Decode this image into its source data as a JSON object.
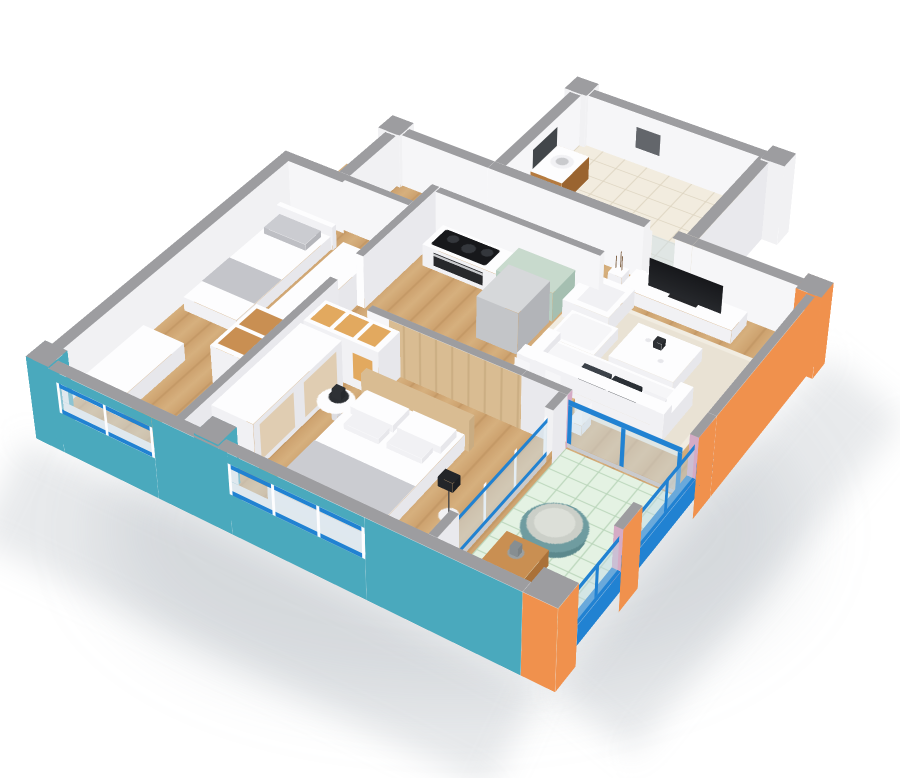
{
  "scene": {
    "title": "Two-bedroom apartment - 3D cutaway isometric floor plan",
    "view": "bird's-eye isometric render",
    "background": "#ffffff",
    "wall_tops": "gray",
    "exterior_walls": {
      "south": "teal",
      "east": "orange",
      "north": "white",
      "west": "white"
    },
    "window_style": "blue rails with white mullions and glass",
    "wall_cut_ends": "pink",
    "balcony_railing": "blue frame with glass panels"
  },
  "rooms": [
    {
      "id": "bathroom",
      "name": "Bathroom",
      "floor": "cream tile",
      "items": [
        "wood vanity with sink",
        "wall mirror",
        "toilet",
        "dark towel",
        "marble feature wall"
      ]
    },
    {
      "id": "hallway",
      "name": "Entrance Hall",
      "floor": "wood",
      "items": []
    },
    {
      "id": "kitchen",
      "name": "Kitchen",
      "floor": "wood",
      "items": [
        "counter with black cooktop",
        "built-in oven",
        "sage green cabinet",
        "gray refrigerator column"
      ]
    },
    {
      "id": "living",
      "name": "Living Room",
      "floor": "wood",
      "items": [
        "flat-screen TV",
        "white media stand",
        "vase with dry branches",
        "white sofa with chaise",
        "dark accent pillows",
        "white cube armchair",
        "white coffee table with cups",
        "beige rug"
      ]
    },
    {
      "id": "dining",
      "name": "Dining Area",
      "floor": "wood",
      "items": [
        "wooden dining table",
        "white chairs",
        "green potted plant"
      ]
    },
    {
      "id": "kids-bedroom",
      "name": "Kids Bedroom",
      "floor": "wood",
      "items": [
        "single bed with gray pillow",
        "open shelving with wood cubbies",
        "white desk"
      ]
    },
    {
      "id": "master-bedroom",
      "name": "Master Bedroom",
      "floor": "wood",
      "items": [
        "double bed with white pillows",
        "gray bed runner",
        "wood headboard wall panel",
        "white wardrobe",
        "cubby shelf",
        "round nightstand with fan",
        "floor lamp"
      ]
    },
    {
      "id": "balcony",
      "name": "Balcony",
      "floor": "mint tile",
      "items": [
        "teal papasan chair",
        "wooden side table with vase",
        "white pouf"
      ]
    }
  ],
  "palette": {
    "background": "#ffffff",
    "wall_cap": "#9d9da0",
    "wall_white": "#f6f6f8",
    "wall_white_bright": "#fbfbfc",
    "wall_white_soft": "#f1f1f3",
    "wall_white_shade": "#e9e9ed",
    "teal": "#4aa9bd",
    "orange": "#f0914d",
    "blue": "#2182d2",
    "blue_deep": "#1a6cb4",
    "pink": "#d5abc5",
    "glass": "rgba(206,224,234,0.5)",
    "glass_balcony": "rgba(190,215,230,0.45)",
    "wood_floor": "#cda26f",
    "wood_floor_light": "#d6b07e",
    "wood_floor_dark": "#bb905e",
    "wood_shelf": "#e2a95f",
    "wood_shelf_deep": "#c98f52",
    "headboard_wood": "#d9bc92",
    "sage": "#b7cec2",
    "sage_light": "#c8dacd",
    "sage_dark": "#a5bfb1",
    "mint": "#e4f2e3",
    "mint_line": "#b8d4b8",
    "cream": "#f2ecdf",
    "cream_line": "#ddd4c0",
    "marble_a": "#efe9dc",
    "marble_b": "#dcd4c2",
    "white": "#fdfdfe",
    "white_soft": "#f1f1f4",
    "white_shade": "#e7e7eb",
    "gray_pillow": "#cbccd1",
    "gray_runner": "#c4c5ca",
    "dark": "#2e3135",
    "tv_black": "#17181b",
    "steel": "#c9cacd",
    "rug": "#e9e2d4",
    "rug_border": "#f1ece1",
    "plant": "#5fa65a",
    "plant_dark": "#4c8c49",
    "vanity_wood": "#b57a3e",
    "vanity_wood_dark": "#9a6430",
    "mirror": "#42464a",
    "papasan": "#6f9ca0",
    "papasan_dark": "#5c898d",
    "cushion": "#cbcfc8",
    "cushion_light": "#dcdfd8",
    "lamp": "#232529",
    "twig": "#7d5f42",
    "towel": "#63666b",
    "fridge_top": "#d6d8da",
    "fridge_side": "#c3c5c8",
    "fridge_dark": "#b2b4b8",
    "shadow": "rgba(130,138,150,0.18)"
  }
}
